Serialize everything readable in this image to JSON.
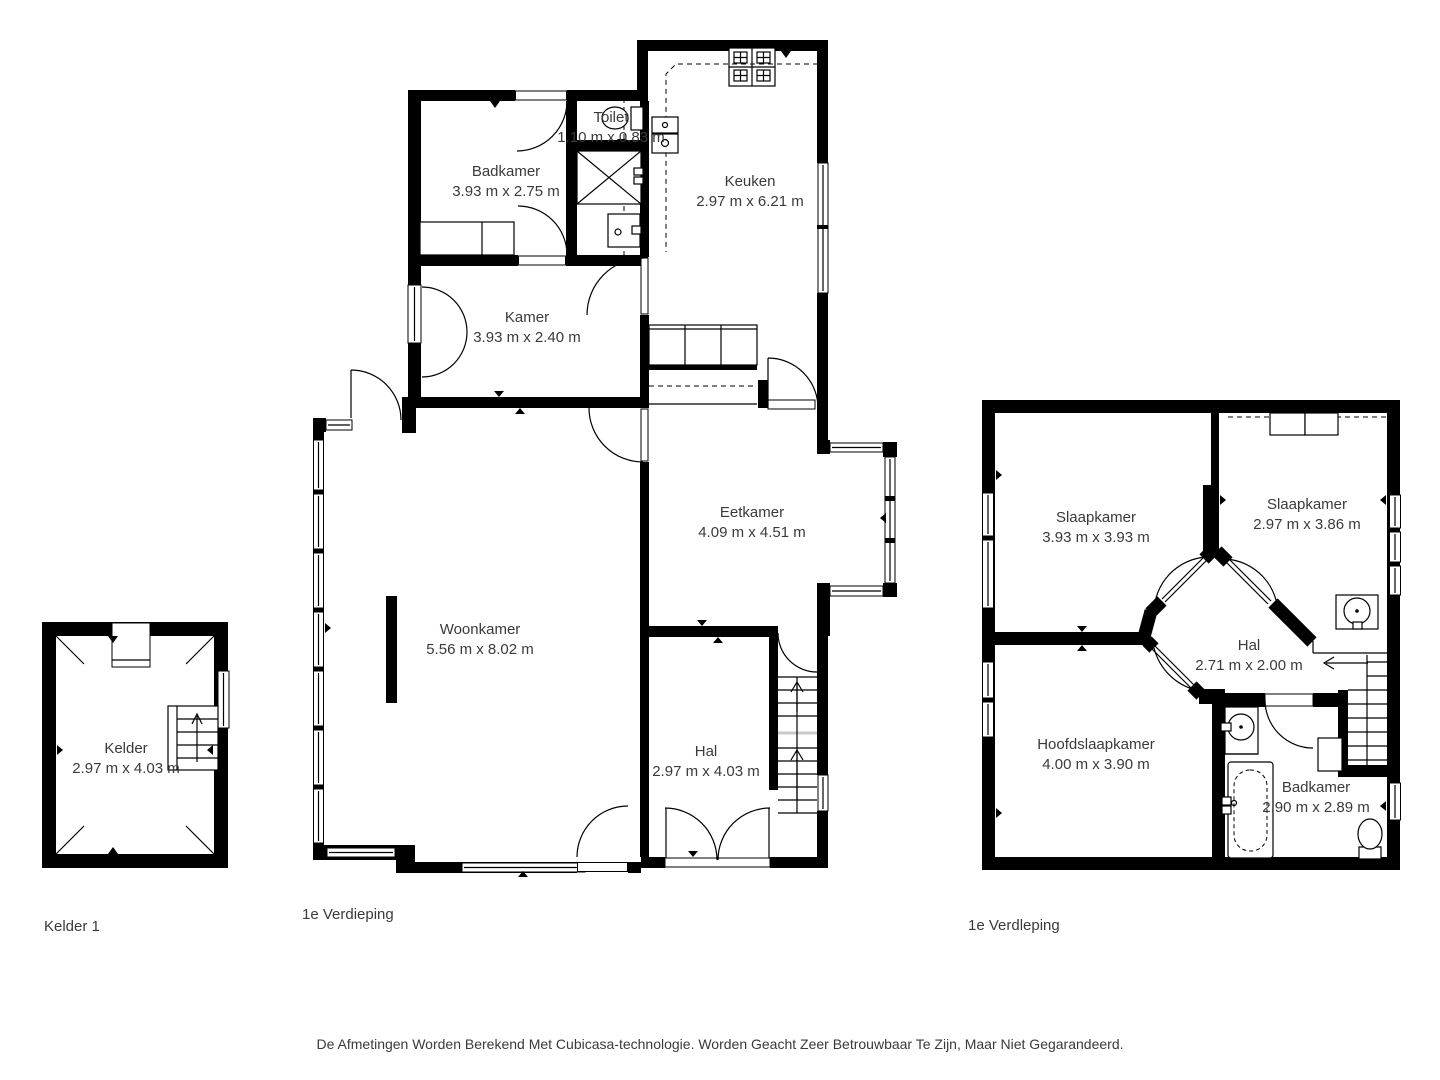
{
  "floors": [
    {
      "id": "kelder",
      "label": "Kelder 1",
      "rooms": [
        {
          "name": "Kelder",
          "dimensions": "2.97 m x 4.03 m"
        }
      ]
    },
    {
      "id": "first-floor",
      "label": "1e Verdieping",
      "rooms": [
        {
          "name": "Badkamer",
          "dimensions": "3.93 m x 2.75 m"
        },
        {
          "name": "Toilet",
          "dimensions": "1.10 m x 0.83 m"
        },
        {
          "name": "Keuken",
          "dimensions": "2.97 m x 6.21 m"
        },
        {
          "name": "Kamer",
          "dimensions": "3.93 m x 2.40 m"
        },
        {
          "name": "Woonkamer",
          "dimensions": "5.56 m x 8.02 m"
        },
        {
          "name": "Eetkamer",
          "dimensions": "4.09 m x 4.51 m"
        },
        {
          "name": "Hal",
          "dimensions": "2.97 m x 4.03 m"
        }
      ]
    },
    {
      "id": "second-floor",
      "label": "1e Verdleping",
      "rooms": [
        {
          "name": "Slaapkamer",
          "dimensions": "3.93 m x 3.93 m"
        },
        {
          "name": "Slaapkamer",
          "dimensions": "2.97 m x 3.86 m"
        },
        {
          "name": "Hal",
          "dimensions": "2.71 m x 2.00 m"
        },
        {
          "name": "Hoofdslaapkamer",
          "dimensions": "4.00 m x 3.90 m"
        },
        {
          "name": "Badkamer",
          "dimensions": "2.90 m x 2.89 m"
        }
      ]
    }
  ],
  "footer": "De Afmetingen Worden Berekend Met Cubicasa-technologie. Worden Geacht Zeer Betrouwbaar Te Zijn, Maar Niet Gegarandeerd.",
  "colors": {
    "wall": "#000000",
    "text": "#3a3a3a",
    "background": "#ffffff"
  }
}
